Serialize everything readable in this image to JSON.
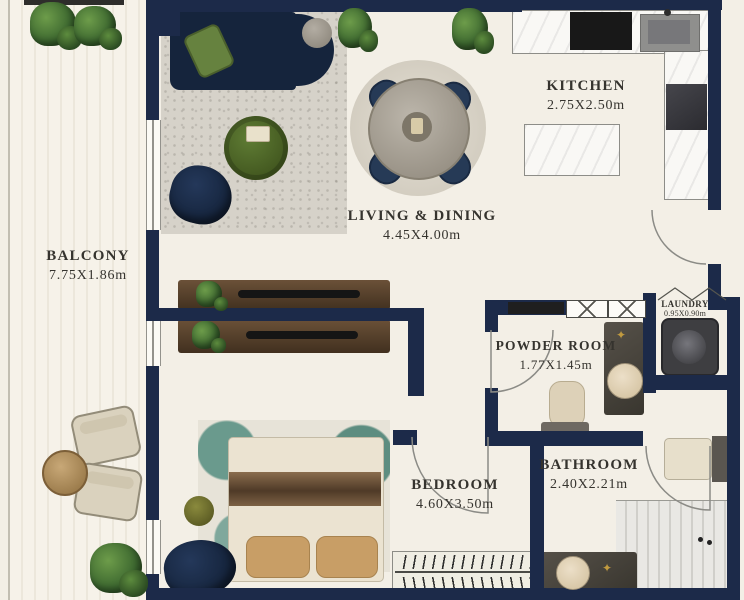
{
  "palette": {
    "wall": "#1c2a49",
    "floor": "#f3efe6",
    "sofa": "#15243c",
    "marble": "#f9f8f5",
    "gold": "#c19a3f",
    "text": "#35332e",
    "accent_green": "#55712d",
    "teal_rug": "#4f8276",
    "bed": "#ebe3d1",
    "pillow": "#c89e66"
  },
  "rooms": {
    "balcony": {
      "name": "BALCONY",
      "dims": "7.75X1.86m"
    },
    "living_dining": {
      "name": "LIVING & DINING",
      "dims": "4.45X4.00m"
    },
    "kitchen": {
      "name": "KITCHEN",
      "dims": "2.75X2.50m"
    },
    "powder_room": {
      "name": "POWDER ROOM",
      "dims": "1.77X1.45m"
    },
    "laundry": {
      "name": "LAUNDRY",
      "dims": "0.95X0.90m"
    },
    "bedroom": {
      "name": "BEDROOM",
      "dims": "4.60X3.50m"
    },
    "bathroom": {
      "name": "BATHROOM",
      "dims": "2.40X2.21m"
    }
  },
  "icons": {
    "decor_star": "✦"
  }
}
